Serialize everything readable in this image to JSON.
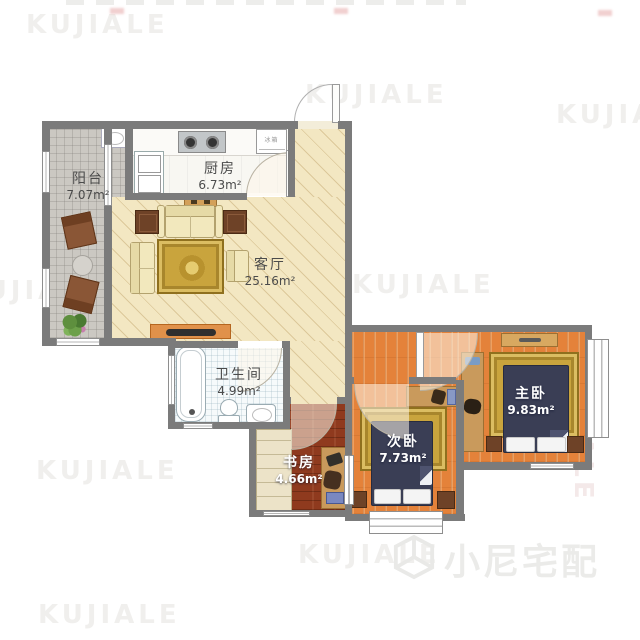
{
  "branding": {
    "watermark": "KUJIALE",
    "logo_text": "小尼宅配"
  },
  "rooms": [
    {
      "name": "阳台",
      "area": "7.07m²"
    },
    {
      "name": "厨房",
      "area": "6.73m²"
    },
    {
      "name": "客厅",
      "area": "25.16m²"
    },
    {
      "name": "卫生间",
      "area": "4.99m²"
    },
    {
      "name": "书房",
      "area": "4.66m²"
    },
    {
      "name": "次卧",
      "area": "7.73m²"
    },
    {
      "name": "主卧",
      "area": "9.83m²"
    }
  ],
  "appliances": {
    "fridge": "冰箱"
  },
  "colors": {
    "wall": "#7b7b7b",
    "living_floor": "#f3e7c2",
    "bedroom_floor": "#e4823a",
    "study_floor": "#8f3a1e",
    "bed_cover": "#3a3e55",
    "rug": "#c9a43d",
    "balcony_tile": "#cbc8c2"
  }
}
